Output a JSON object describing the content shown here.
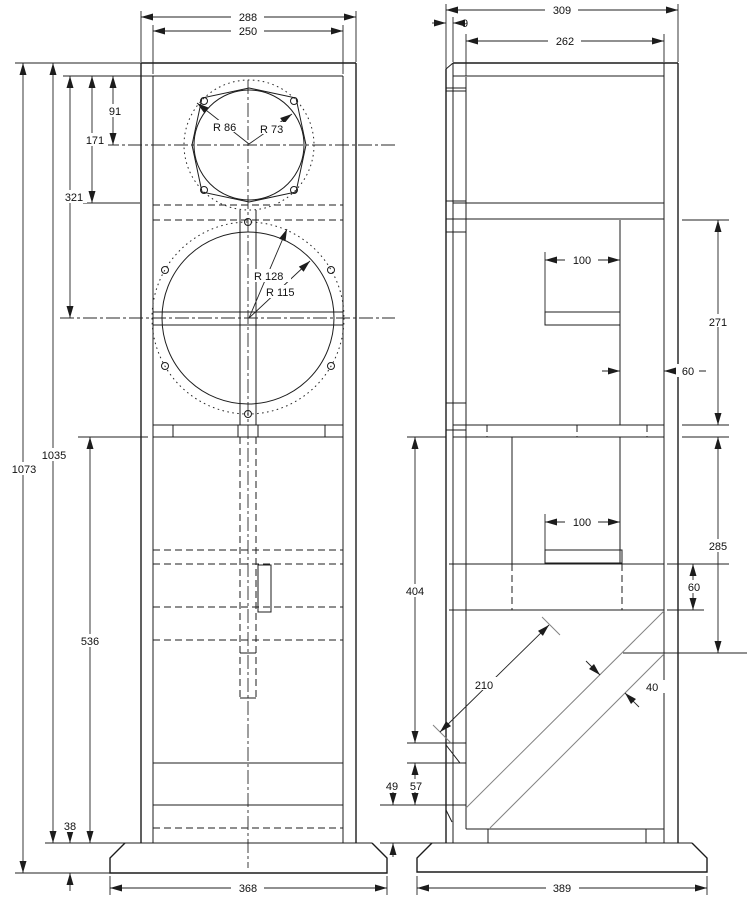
{
  "drawing": {
    "front": {
      "overall_width": "288",
      "baffle_width": "250",
      "tweeter_center_offset": "91",
      "tweeter_shelf_offset": "171",
      "woofer_center_offset": "321",
      "cabinet_height": "1035",
      "overall_height": "1073",
      "lower_chamber_height": "536",
      "plinth_height": "38",
      "plinth_width": "368",
      "tweeter_flange_radius": "R 86",
      "tweeter_cutout_radius": "R 73",
      "woofer_flange_radius": "R 128",
      "woofer_cutout_radius": "R 115"
    },
    "side": {
      "overall_depth": "309",
      "front_panel_thickness": "9",
      "inner_depth": "262",
      "upper_bracket_depth": "100",
      "upper_chamber_height": "271",
      "rear_gap": "60",
      "lower_section_height": "404",
      "lower_bracket_depth": "100",
      "lower_chamber_height": "285",
      "shelf_band_height": "60",
      "brace_length": "210",
      "brace_width": "40",
      "foot_gap": "49",
      "bottom_panel_height": "57",
      "plinth_depth": "389"
    }
  }
}
